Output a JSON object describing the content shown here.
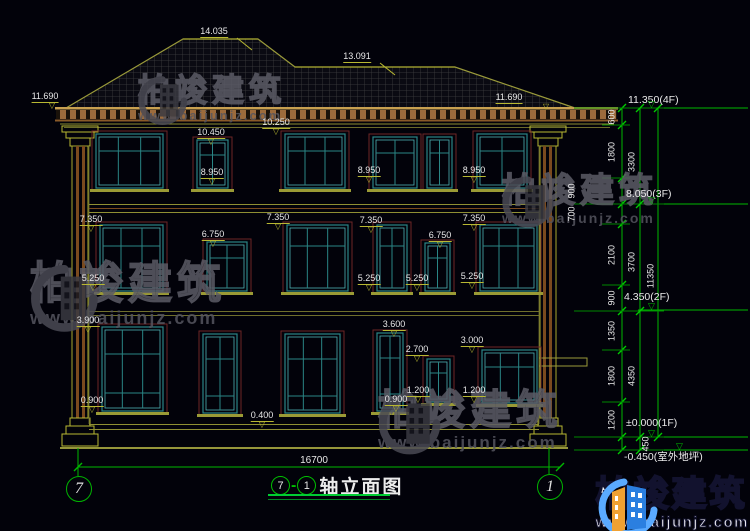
{
  "drawing": {
    "title": {
      "bubble_left": "7",
      "dash": "-",
      "bubble_right": "1",
      "text": "轴立面图"
    },
    "axis_bubbles": {
      "left": "7",
      "right": "1"
    },
    "bottom_dimension": "16700",
    "elevation_labels": [
      {
        "t": "14.035",
        "x": 214,
        "y": 27,
        "flag": true
      },
      {
        "t": "13.091",
        "x": 357,
        "y": 52,
        "flag": true
      },
      {
        "t": "11.690",
        "x": 45,
        "y": 92,
        "tx": 7
      },
      {
        "t": "11.690",
        "x": 509,
        "y": 93,
        "tx": 37
      },
      {
        "t": "10.450",
        "x": 211,
        "y": 128
      },
      {
        "t": "10.250",
        "x": 276,
        "y": 118
      },
      {
        "t": "8.950",
        "x": 212,
        "y": 168
      },
      {
        "t": "8.950",
        "x": 369,
        "y": 166
      },
      {
        "t": "8.950",
        "x": 474,
        "y": 166
      },
      {
        "t": "7.350",
        "x": 91,
        "y": 215
      },
      {
        "t": "7.350",
        "x": 278,
        "y": 213
      },
      {
        "t": "7.350",
        "x": 371,
        "y": 216
      },
      {
        "t": "7.350",
        "x": 474,
        "y": 214
      },
      {
        "t": "6.750",
        "x": 213,
        "y": 230
      },
      {
        "t": "6.750",
        "x": 440,
        "y": 231
      },
      {
        "t": "5.250",
        "x": 93,
        "y": 274
      },
      {
        "t": "5.250",
        "x": 369,
        "y": 274
      },
      {
        "t": "5.250",
        "x": 417,
        "y": 274
      },
      {
        "t": "5.250",
        "x": 472,
        "y": 272
      },
      {
        "t": "3.900",
        "x": 88,
        "y": 316
      },
      {
        "t": "3.600",
        "x": 394,
        "y": 320
      },
      {
        "t": "3.000",
        "x": 472,
        "y": 336
      },
      {
        "t": "2.700",
        "x": 417,
        "y": 345
      },
      {
        "t": "1.200",
        "x": 418,
        "y": 386
      },
      {
        "t": "1.200",
        "x": 474,
        "y": 386
      },
      {
        "t": "0.900",
        "x": 92,
        "y": 396
      },
      {
        "t": "0.900",
        "x": 396,
        "y": 395
      },
      {
        "t": "0.400",
        "x": 262,
        "y": 411
      }
    ],
    "floor_markers": [
      {
        "t": "11.350(4F)",
        "x": 690,
        "y": 95,
        "ly": 108
      },
      {
        "t": "8.050(3F)",
        "x": 688,
        "y": 189,
        "ly": 204
      },
      {
        "t": "4.350(2F)",
        "x": 686,
        "y": 292,
        "ly": 310
      },
      {
        "t": "±0.000(1F)",
        "x": 688,
        "y": 418,
        "ly": 437
      },
      {
        "t": "-0.450(室外地坪)",
        "x": 686,
        "y": 452,
        "ly": 450,
        "below": true
      }
    ],
    "dim_chains": {
      "inner_ticks": [
        108,
        125,
        178,
        204,
        224,
        285,
        311,
        350,
        402,
        437,
        450
      ],
      "mid_ticks": [
        108,
        204,
        311,
        437,
        450
      ],
      "outer_ticks": [
        108,
        437
      ],
      "inner_values": [
        {
          "v": "600",
          "x": 612,
          "y": 117
        },
        {
          "v": "1800",
          "x": 612,
          "y": 152
        },
        {
          "v": "900",
          "x": 572,
          "y": 191
        },
        {
          "v": "700",
          "x": 572,
          "y": 214
        },
        {
          "v": "2100",
          "x": 612,
          "y": 255
        },
        {
          "v": "900",
          "x": 612,
          "y": 298
        },
        {
          "v": "1350",
          "x": 612,
          "y": 331
        },
        {
          "v": "1800",
          "x": 612,
          "y": 376
        },
        {
          "v": "1200",
          "x": 612,
          "y": 420
        },
        {
          "v": "450",
          "x": 646,
          "y": 444
        }
      ],
      "mid_values": [
        {
          "v": "3300",
          "x": 632,
          "y": 162
        },
        {
          "v": "3700",
          "x": 632,
          "y": 262
        },
        {
          "v": "4350",
          "x": 632,
          "y": 376
        }
      ],
      "outer_values": [
        {
          "v": "11350",
          "x": 651,
          "y": 276
        }
      ]
    },
    "windows": [
      {
        "x": 96,
        "y": 134,
        "w": 67,
        "h": 54,
        "cols": 3
      },
      {
        "x": 197,
        "y": 140,
        "w": 31,
        "h": 48,
        "cols": 2
      },
      {
        "x": 285,
        "y": 134,
        "w": 60,
        "h": 54,
        "cols": 3
      },
      {
        "x": 373,
        "y": 137,
        "w": 44,
        "h": 51,
        "cols": 2
      },
      {
        "x": 427,
        "y": 137,
        "w": 25,
        "h": 51,
        "cols": 1
      },
      {
        "x": 477,
        "y": 134,
        "w": 50,
        "h": 54,
        "cols": 2
      },
      {
        "x": 100,
        "y": 225,
        "w": 63,
        "h": 66,
        "cols": 3
      },
      {
        "x": 207,
        "y": 242,
        "w": 40,
        "h": 49,
        "cols": 2
      },
      {
        "x": 287,
        "y": 225,
        "w": 61,
        "h": 66,
        "cols": 3
      },
      {
        "x": 377,
        "y": 225,
        "w": 30,
        "h": 66,
        "cols": 2
      },
      {
        "x": 425,
        "y": 243,
        "w": 25,
        "h": 48,
        "cols": 1
      },
      {
        "x": 480,
        "y": 225,
        "w": 57,
        "h": 66,
        "cols": 3
      },
      {
        "x": 102,
        "y": 327,
        "w": 61,
        "h": 84,
        "cols": 3
      },
      {
        "x": 203,
        "y": 334,
        "w": 34,
        "h": 79,
        "cols": 2
      },
      {
        "x": 285,
        "y": 334,
        "w": 55,
        "h": 79,
        "cols": 3
      },
      {
        "x": 377,
        "y": 333,
        "w": 26,
        "h": 78,
        "cols": 2
      },
      {
        "x": 427,
        "y": 359,
        "w": 23,
        "h": 43,
        "cols": 1
      },
      {
        "x": 482,
        "y": 350,
        "w": 55,
        "h": 53,
        "cols": 3
      }
    ]
  },
  "watermarks": [
    {
      "brand": "柏竣建筑",
      "url": "www.baijunjz.com",
      "x": 136,
      "y": 74,
      "s": 0.95
    },
    {
      "brand": "柏竣建筑",
      "url": "www.baijunjz.com",
      "x": 500,
      "y": 174,
      "s": 1.0
    },
    {
      "brand": "柏竣建筑",
      "url": "www.baijunjz.com",
      "x": 28,
      "y": 262,
      "s": 1.3
    },
    {
      "brand": "柏竣建筑",
      "url": "www.baijunjz.com",
      "x": 376,
      "y": 390,
      "s": 1.2
    }
  ],
  "logo": {
    "brand": "柏竣建筑",
    "url": "www.baijunjz.com"
  },
  "colors": {
    "background": "#02020a",
    "facade_olive": "#9a9a3a",
    "facade_yellow": "#c8c84a",
    "cornice_tan": "#c8a050",
    "cornice_brown": "#9c6b3c",
    "window_teal": "#2a8585",
    "window_teal_bright": "#4fb3b3",
    "window_casing_red": "#6e2626",
    "sill_olive": "#9a9a35",
    "dimension_green": "#00b800",
    "text_white": "#e8e8e8",
    "watermark_gray": "#4c4c56",
    "roof_grid": "#3e3e40",
    "logo_orange": "#f0a132",
    "logo_blue": "#2b7fe0",
    "logo_lightblue": "#5aaaff"
  }
}
